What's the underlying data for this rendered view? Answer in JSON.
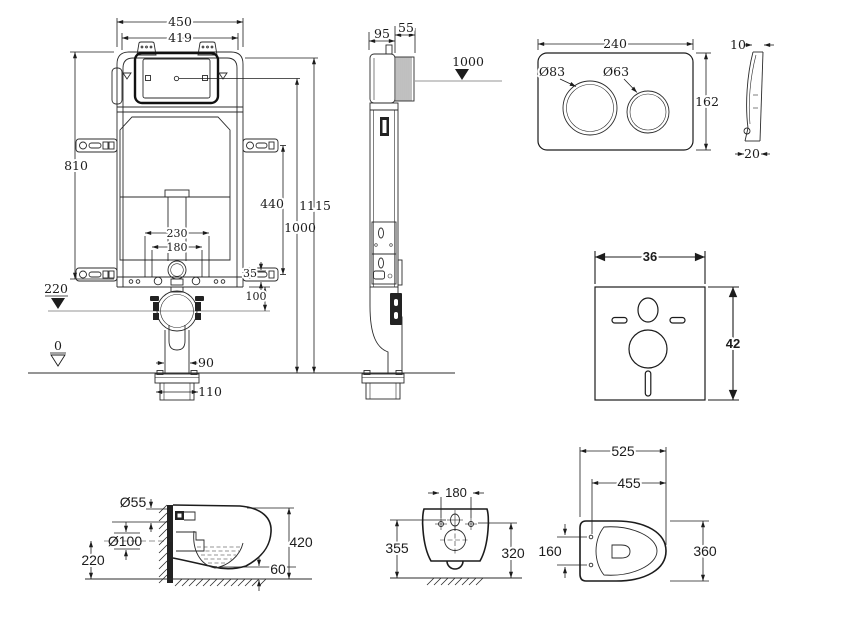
{
  "colors": {
    "line": "#1c1c1c",
    "background": "#ffffff",
    "fill_dark": "#222222"
  },
  "cistern_front": {
    "width": "450",
    "inner_width": "419",
    "height": "810",
    "bracket_spacing": "440",
    "total_height": "1115",
    "flush_center_height": "1000",
    "bolt_spacing_outer": "230",
    "bolt_spacing_inner": "180",
    "offset": "35",
    "frame_to_drain": "100",
    "drain_level": "220",
    "floor_level": "0",
    "pipe_width": "90",
    "flange_width": "110"
  },
  "cistern_side": {
    "depth": "95",
    "housing_depth": "55",
    "flush_height": "1000"
  },
  "flush_plate": {
    "width": "240",
    "height": "162",
    "big_button": "Ø83",
    "small_button": "Ø63",
    "thickness": "10",
    "depth": "20"
  },
  "sound_mat": {
    "width": "36",
    "height": "42"
  },
  "toilet_side": {
    "inlet": "Ø55",
    "outlet": "Ø100",
    "outlet_height": "220",
    "height": "420",
    "clearance": "60"
  },
  "toilet_rear": {
    "hole_spacing": "180",
    "height_left": "355",
    "height_right": "320"
  },
  "toilet_top": {
    "length": "525",
    "hole_to_front": "455",
    "hole_spacing": "160",
    "width": "360"
  }
}
